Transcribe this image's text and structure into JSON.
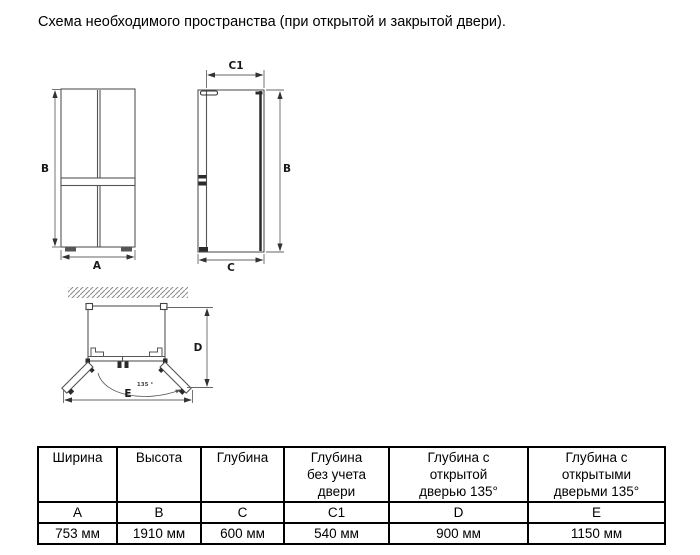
{
  "title": "Схема необходимого пространства (при открытой и закрытой двери).",
  "diagram": {
    "labels": {
      "width": "A",
      "height": "B",
      "depth": "C",
      "depth_no_door": "C1",
      "depth_door_open": "D",
      "depth_doors_open": "E",
      "angle": "135 °"
    },
    "colors": {
      "line": "#555555",
      "dark": "#2b2b2b",
      "hatch": "#8a8a8a"
    }
  },
  "table": {
    "headers": [
      "Ширина",
      "Высота",
      "Глубина",
      "Глубина\nбез учета\nдвери",
      "Глубина с\nоткрытой\nдверью 135°",
      "Глубина с\nоткрытыми\nдверьми 135°"
    ],
    "letters": [
      "A",
      "B",
      "C",
      "C1",
      "D",
      "E"
    ],
    "values": [
      "753 мм",
      "1910 мм",
      "600 мм",
      "540 мм",
      "900 мм",
      "1150 мм"
    ]
  }
}
